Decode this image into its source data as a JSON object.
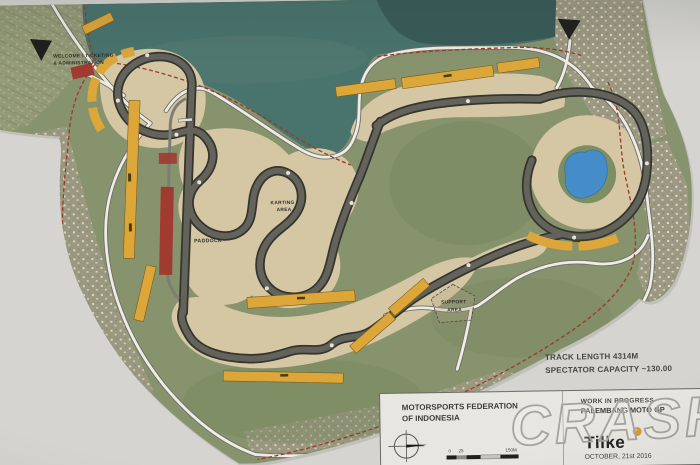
{
  "colors": {
    "paper": "#d8d7d2",
    "land": "#87946a",
    "land_dark": "#73875a",
    "lake": "#45736d",
    "lake_dark": "#2f5150",
    "sand": "#d9c9a2",
    "track": "#62625a",
    "track_edge": "#33332c",
    "road": "#f1efe8",
    "grandstand": "#e3a72e",
    "pit_building": "#a8362b",
    "pond": "#3e8ed0",
    "boundary": "#a23526",
    "arrow": "#1c1c1a",
    "gold": "#d89b2e"
  },
  "map_labels": {
    "welcome_line1": "WELCOME / TICKETING",
    "welcome_line2": "& ADMINISTRATION",
    "paddock": "PADDOCK",
    "karting_line1": "KARTING",
    "karting_line2": "AREA",
    "support_line1": "SUPPORT",
    "support_line2": "AREA"
  },
  "annotations": {
    "track_length": "TRACK LENGTH 4314M",
    "spectator_capacity": "SPECTATOR CAPACITY ~130.00"
  },
  "title_block": {
    "org_line1": "MOTORSPORTS FEDERATION",
    "org_line2": "OF INDONESIA",
    "status": "WORK IN PROGRESS",
    "project": "PALEMBANG MOTO GP",
    "company": "Tilke",
    "date": "OCTOBER, 21st 2016",
    "scale_zero": "0",
    "scale_mid": "25",
    "scale_end": "150M"
  },
  "watermark": "CRASH"
}
